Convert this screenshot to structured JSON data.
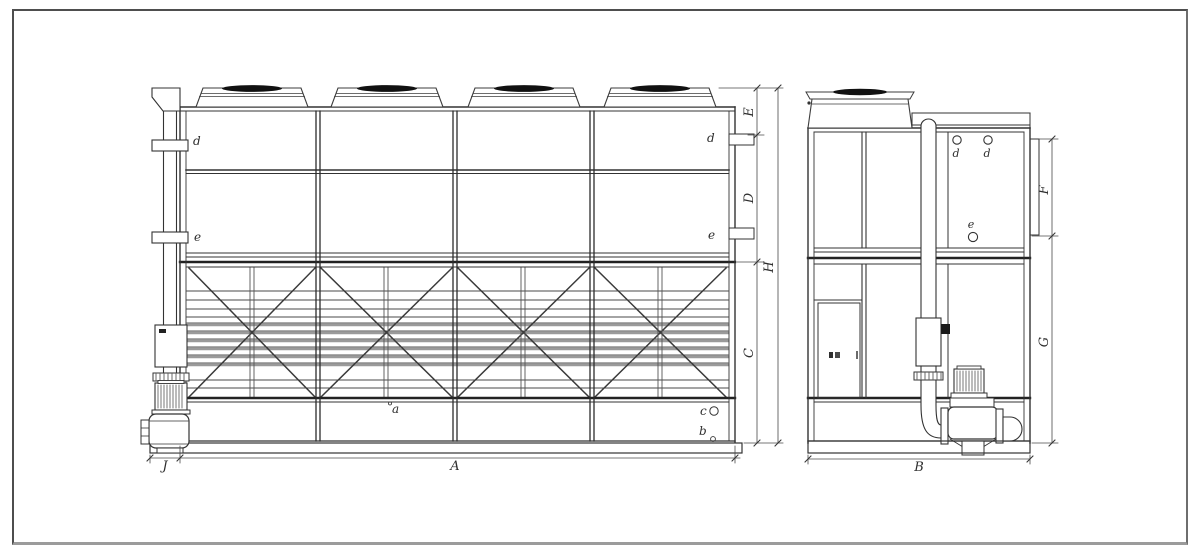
{
  "front_view": {
    "labels": {
      "d_left": "d",
      "d_right": "d",
      "e_left": "e",
      "e_right": "e",
      "a": "a",
      "b": "b",
      "c": "c"
    },
    "dims": {
      "A": "A",
      "J": "J",
      "E": "E",
      "D": "D",
      "H": "H",
      "C": "C"
    }
  },
  "side_view": {
    "labels": {
      "d1": "d",
      "d2": "d",
      "e": "e"
    },
    "dims": {
      "B": "B",
      "F": "F",
      "G": "G"
    }
  },
  "colors": {
    "line": "#3d3d3d",
    "dark": "#1f1f1f",
    "louver_gray": "#9a9a9a",
    "fan_blade": "#111111",
    "sheet_border": "#4e4e4e",
    "sheet_border_bottom": "#9b9b9b",
    "background": "#ffffff"
  }
}
